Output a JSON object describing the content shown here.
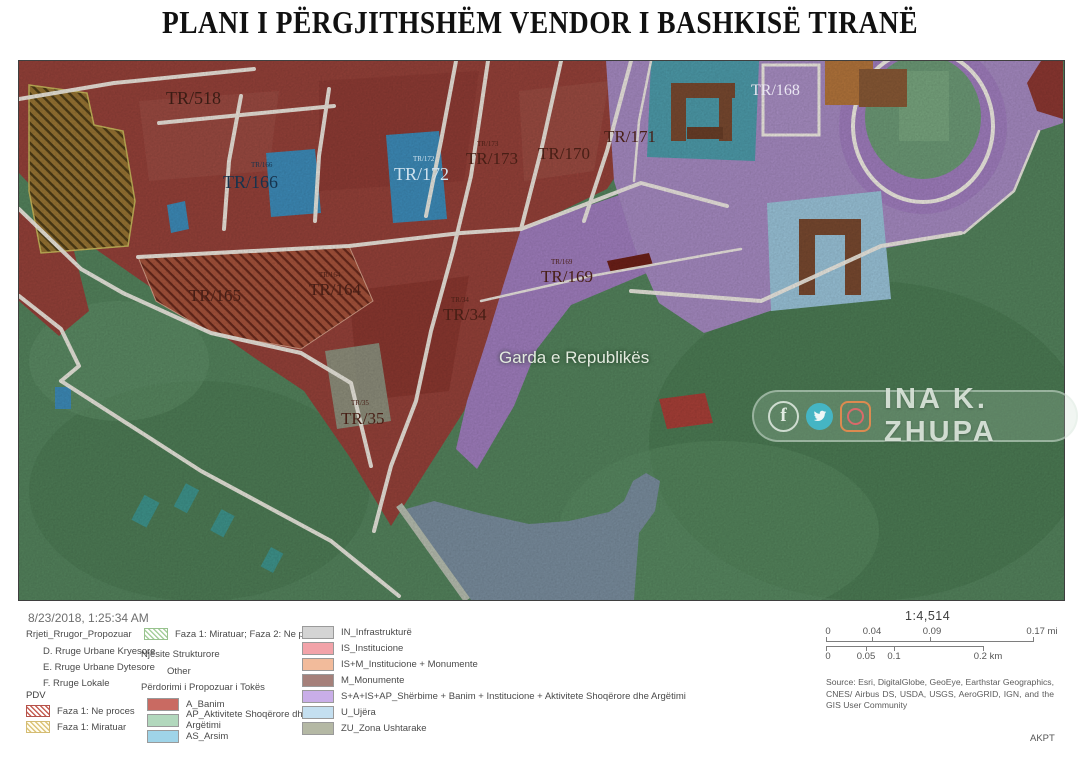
{
  "title": "PLANI I PËRGJITHSHËM VENDOR I BASHKISË TIRANË",
  "map": {
    "labels": [
      {
        "text": "TR/518",
        "x": 147,
        "y": 28,
        "size": 18,
        "color": "#3a1c14",
        "font": "serif"
      },
      {
        "text": "TR/166",
        "x": 232,
        "y": 101,
        "size": 7,
        "color": "#17334d",
        "font": "serif"
      },
      {
        "text": "TR/166",
        "x": 204,
        "y": 112,
        "size": 18,
        "color": "#17334d",
        "font": "serif"
      },
      {
        "text": "TR/172",
        "x": 394,
        "y": 95,
        "size": 7,
        "color": "#cfe2ee",
        "font": "serif"
      },
      {
        "text": "TR/172",
        "x": 375,
        "y": 104,
        "size": 18,
        "color": "#cfe2ee",
        "font": "serif"
      },
      {
        "text": "TR/173",
        "x": 458,
        "y": 80,
        "size": 7,
        "color": "#471e15",
        "font": "serif"
      },
      {
        "text": "TR/173",
        "x": 447,
        "y": 89,
        "size": 17,
        "color": "#471e15",
        "font": "serif"
      },
      {
        "text": "TR/170",
        "x": 519,
        "y": 84,
        "size": 17,
        "color": "#471e15",
        "font": "serif"
      },
      {
        "text": "TR/171",
        "x": 585,
        "y": 67,
        "size": 17,
        "color": "#471e15",
        "font": "serif"
      },
      {
        "text": "TR/168",
        "x": 732,
        "y": 22,
        "size": 16,
        "color": "#eae6f2",
        "font": "serif"
      },
      {
        "text": "TR/165",
        "x": 170,
        "y": 226,
        "size": 17,
        "color": "#471e15",
        "font": "serif"
      },
      {
        "text": "TR/164",
        "x": 300,
        "y": 211,
        "size": 7,
        "color": "#471e15",
        "font": "serif"
      },
      {
        "text": "TR/164",
        "x": 290,
        "y": 220,
        "size": 17,
        "color": "#471e15",
        "font": "serif"
      },
      {
        "text": "TR/34",
        "x": 432,
        "y": 236,
        "size": 7,
        "color": "#471e15",
        "font": "serif"
      },
      {
        "text": "TR/34",
        "x": 424,
        "y": 245,
        "size": 17,
        "color": "#471e15",
        "font": "serif"
      },
      {
        "text": "TR/169",
        "x": 532,
        "y": 198,
        "size": 7,
        "color": "#471e15",
        "font": "serif"
      },
      {
        "text": "TR/169",
        "x": 522,
        "y": 207,
        "size": 17,
        "color": "#471e15",
        "font": "serif"
      },
      {
        "text": "TR/35",
        "x": 332,
        "y": 339,
        "size": 7,
        "color": "#471e15",
        "font": "serif"
      },
      {
        "text": "TR/35",
        "x": 322,
        "y": 349,
        "size": 17,
        "color": "#471e15",
        "font": "serif"
      },
      {
        "text": "Garda e Republikës",
        "x": 480,
        "y": 288,
        "size": 17,
        "color": "#e3ebdf",
        "font": "sans"
      }
    ],
    "watermark": {
      "text": "INA K. ZHUPA",
      "fb": "f"
    }
  },
  "legend": {
    "timestamp": "8/23/2018, 1:25:34 AM",
    "roads_header": "Rrjeti_Rrugor_Propozuar",
    "roads_items": [
      "D. Rruge Urbane Kryesore",
      "E. Rruge Urbane Dytesore",
      "F. Rruge Lokale"
    ],
    "pdv_header": "PDV",
    "pdv_items": [
      {
        "label": "Faza 1: Ne proces",
        "swatch": "hatch-red"
      },
      {
        "label": "Faza 1: Miratuar",
        "swatch": "hatch-yellow"
      }
    ],
    "pdv_extra": {
      "label": "Faza 1: Miratuar; Faza 2: Ne proces",
      "swatch": "hatch-green"
    },
    "structural_header": "Njësite Strukturore",
    "structural_items": [
      "Other"
    ],
    "landuse_header": "Përdorimi i Propozuar i Tokës",
    "landuse_items": [
      {
        "label": "A_Banim",
        "color": "#c96a62"
      },
      {
        "label": "AP_Aktivitete Shoqërore dhe Argëtimi",
        "color": "#b2d8bd"
      },
      {
        "label": "AS_Arsim",
        "color": "#9fd4e8"
      }
    ],
    "landuse_items2": [
      {
        "label": "IN_Infrastrukturë",
        "color": "#d4d4d4"
      },
      {
        "label": "IS_Institucione",
        "color": "#f2a3a9"
      },
      {
        "label": "IS+M_Institucione + Monumente",
        "color": "#f2bb9b"
      },
      {
        "label": "M_Monumente",
        "color": "#a5807a"
      },
      {
        "label": "S+A+IS+AP_Shërbime + Banim + Institucione + Aktivitete Shoqërore dhe Argëtimi",
        "color": "#c9aee8"
      },
      {
        "label": "U_Ujëra",
        "color": "#c4dff0"
      },
      {
        "label": "ZU_Zona Ushtarake",
        "color": "#b4b8a4"
      }
    ]
  },
  "scale": {
    "ratio": "1:4,514",
    "miles": [
      "0",
      "0.04",
      "0.09",
      "0.17 mi"
    ],
    "km": [
      "0",
      "0.05",
      "0.1",
      "0.2 km"
    ]
  },
  "source": "Source: Esri, DigitalGlobe, GeoEye, Earthstar Geographics, CNES/ Airbus DS, USDA, USGS, AeroGRID, IGN, and the GIS User Community",
  "footer": "AKPT",
  "colors": {
    "residential": "#97423a",
    "park": "#55855e",
    "water": "#7b8fa0",
    "purple": "#a27fc0",
    "school_blue": "#3e8dbb",
    "institution_teal": "#4e9dac",
    "roads": "#f3efe6"
  }
}
